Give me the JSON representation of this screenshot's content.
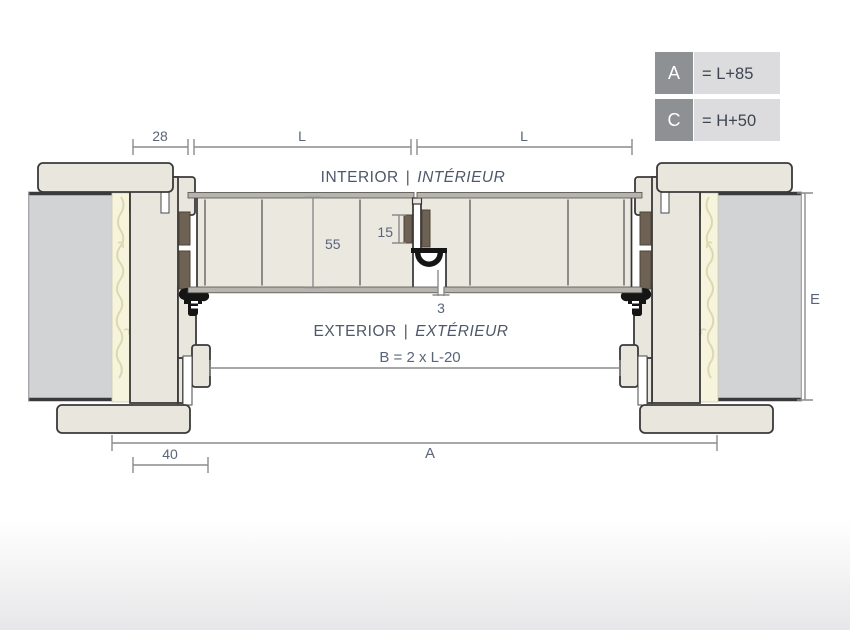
{
  "title": "Double door horizontal section drawing",
  "legend": {
    "rows": [
      {
        "key": "A",
        "value": "= L+85"
      },
      {
        "key": "C",
        "value": "= H+50"
      }
    ],
    "key_box_color": "#8e9194",
    "value_box_color": "#dcdcde"
  },
  "labels": {
    "separator": "|",
    "interior_en": "INTERIOR",
    "interior_fr": "INTÉRIEUR",
    "exterior_en": "EXTERIOR",
    "exterior_fr": "EXTÉRIEUR"
  },
  "dimensions": {
    "frame_offset": "28",
    "leaf_width_left": "L",
    "leaf_width_right": "L",
    "door_thickness": "55",
    "meeting_seal_height": "15",
    "leaf_gap": "3",
    "clear_opening": "B = 2 x L-20",
    "overall_width": "A",
    "frame_depth": "40",
    "wall_thickness": "E"
  },
  "colors": {
    "frame_fill": "#e9e6dd",
    "door_fill": "#ebe8e0",
    "wall_fill": "#d2d3d5",
    "foam_fill": "#f6f4dc",
    "seal_block": "#6e6254",
    "gasket": "#151515",
    "dimension_line": "#8b8b8b",
    "dimension_text": "#5a6577"
  }
}
